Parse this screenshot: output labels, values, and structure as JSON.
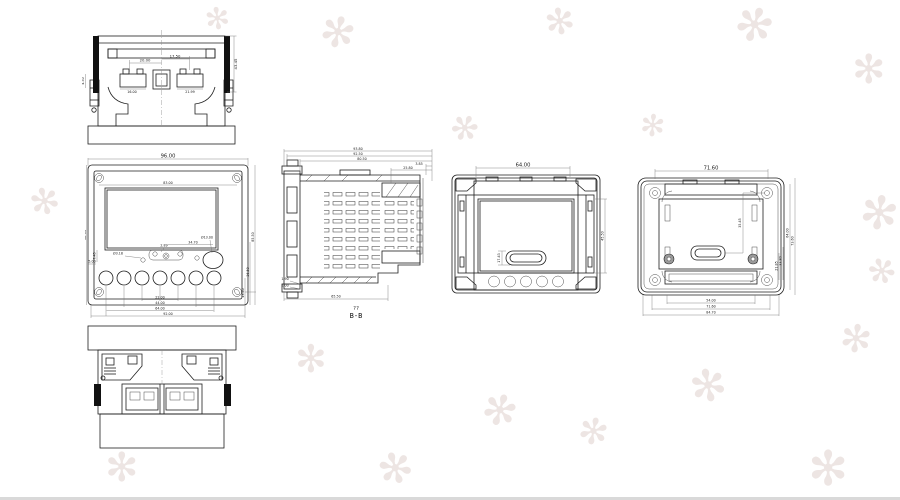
{
  "watermark": {
    "glyph": "✻",
    "color": "#d9c7c2"
  },
  "views": {
    "top": {
      "dims": {
        "d2000": "20.00",
        "d1750": "17.50",
        "d1600": "16.00",
        "d2199": "21.99",
        "d4345": "43.45",
        "d450": "4.50"
      }
    },
    "front": {
      "dims": {
        "overall_w": "96.00",
        "inner_w": "83.00",
        "overall_h": "96.00",
        "d745": "7.45",
        "d500": "5.00",
        "d289": "2.89",
        "hole_small": "Ø3.18",
        "hole_big": "Ø13.00",
        "d3470": "34.70",
        "chain": [
          "22.00",
          "44.00",
          "64.00",
          "92.00"
        ],
        "right_chain": [
          "13.40",
          "36.50",
          "85.50"
        ]
      }
    },
    "section": {
      "sub_label": "??",
      "label": "B-B",
      "dims": {
        "d9380": "93.80",
        "d9250": "92.50",
        "d8050": "80.50",
        "d385": "3.85",
        "d2580": "25.80",
        "d190": "1.90",
        "d100": "1.00",
        "d6550": "65.50"
      }
    },
    "back_a": {
      "dims": {
        "w": "64.00",
        "slot": "17.43",
        "h": "45.50"
      }
    },
    "back_b": {
      "dims": {
        "w": "71.60",
        "inner_v": "35.45",
        "mid1": "21.85",
        "mid2": "33.80",
        "right1": "64.00",
        "right2": "73.60",
        "chain": [
          "54.00",
          "71.60",
          "84.70"
        ]
      }
    }
  }
}
